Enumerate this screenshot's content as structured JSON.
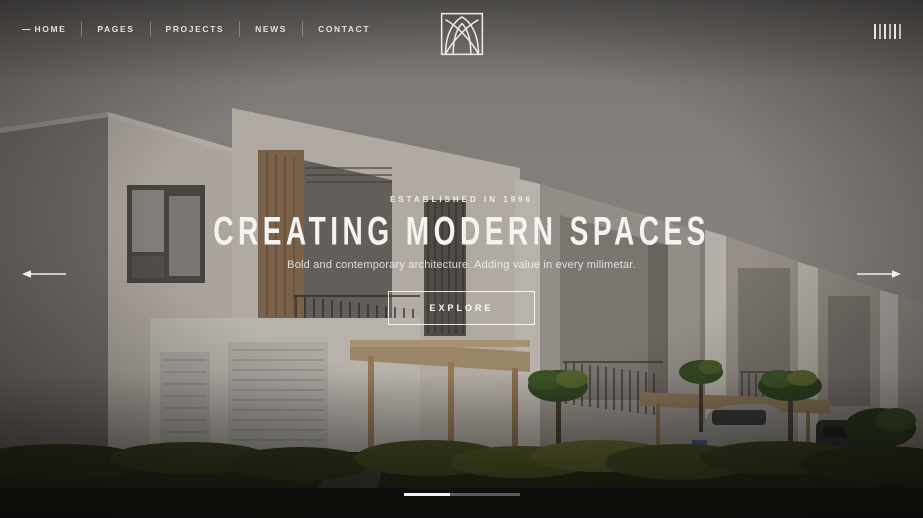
{
  "nav": {
    "active_marker": "—",
    "items": [
      {
        "label": "HOME",
        "active": true
      },
      {
        "label": "PAGES",
        "active": false
      },
      {
        "label": "PROJECTS",
        "active": false
      },
      {
        "label": "NEWS",
        "active": false
      },
      {
        "label": "CONTACT",
        "active": false
      }
    ]
  },
  "icons": {
    "logo": "arch-vault-logo",
    "menu": "vertical-bars-menu",
    "prev": "arrow-left",
    "next": "arrow-right"
  },
  "hero": {
    "eyebrow": "ESTABLISHED IN 1996",
    "title": "CREATING MODERN SPACES",
    "subtitle": "Bold and contemporary architecture. Adding value in every milimetar.",
    "cta_label": "EXPLORE"
  },
  "carousel": {
    "current_slide": 1,
    "total_slides": 2
  },
  "colors": {
    "sky_top": "#8d8a88",
    "sky_bottom": "#a69e97",
    "building_light": "#cfc8c0",
    "building_shade": "#7e7976",
    "wood": "#8a6d52",
    "pergola": "#b59a77",
    "greenery": "#3a441a",
    "text": "#f5f3f0"
  }
}
